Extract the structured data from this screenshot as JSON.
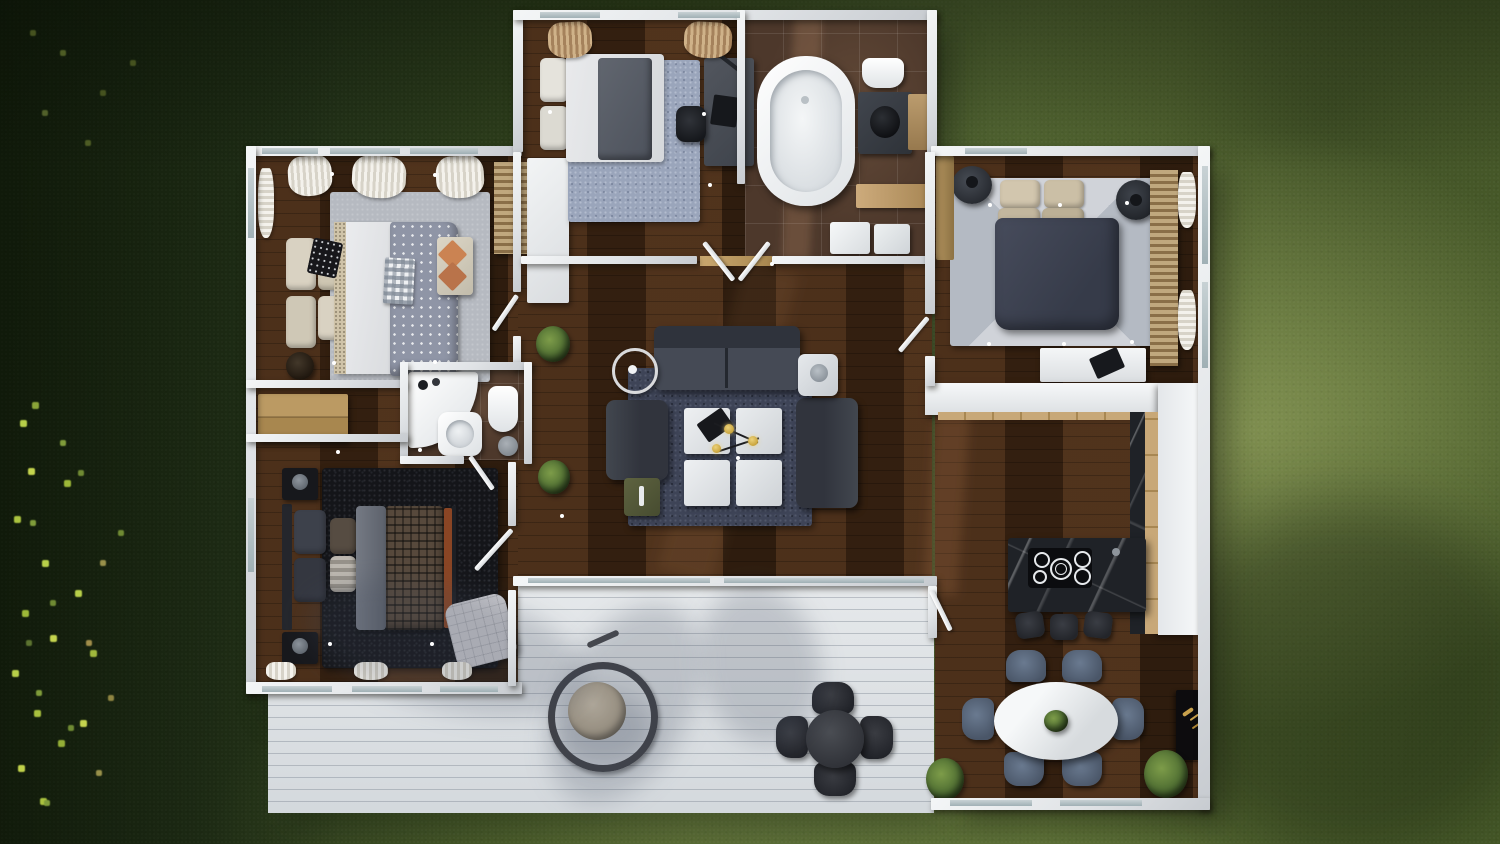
{
  "scene": {
    "type": "3d-architectural-render",
    "view": "top-down-aerial",
    "subject": "single-story furnished house floor plan with white walls, dark wood floors, white deck and surrounding lawn",
    "lighting": "daylight with tree shadows over deck and lawn, scattered leaves on grass at left"
  },
  "palette": {
    "grass-dark": "#1b2911",
    "grass-mid": "#4d6030",
    "grass-light": "#7b8b4e",
    "wood-floor": "#3a2413",
    "tile-brown": "#4d382b",
    "wall-white": "#e8eaec",
    "deck-white": "#dde1e4",
    "rug-light": "#b6bac1",
    "rug-blue": "#9aa5bb",
    "rug-navy": "#3e4457",
    "rug-black": "#141519",
    "rug-master": "#c5c9d0",
    "sofa-charcoal": "#3a3e48",
    "duvet-navy": "#3f4554",
    "pillow-cream": "#d6cfbf",
    "marble-black": "#1f2227",
    "counter-wood": "#c8a878",
    "dining-chair-blue": "#5d6c80",
    "plant-green": "#4c6b31",
    "leaf-bright": "#b7cf49",
    "accent-rust": "#8a4524",
    "accent-orange": "#cb8352",
    "gold-brass": "#c9a43c"
  },
  "rooms": [
    {
      "name": "bedroom-top-left",
      "furniture": [
        "double-bed-polka-dot-duvet",
        "cream-pillow-stacks",
        "light-gray-area-rug",
        "foot-bench-with-orange-trays",
        "checkered-throw",
        "round-side-table-with-lamp",
        "white-window-curtains"
      ]
    },
    {
      "name": "guest-bedroom-office",
      "furniture": [
        "bed-with-gray-throw",
        "blue-gray-rug",
        "desk-with-laptop-and-lamp",
        "black-office-chair",
        "white-wardrobe",
        "tan-curtains"
      ]
    },
    {
      "name": "main-bathroom",
      "furniture": [
        "freestanding-oval-bathtub",
        "dark-vanity-with-black-basin",
        "toilet",
        "wood-shelf",
        "washer-dryer-units",
        "wood-counter",
        "double-open-doors"
      ]
    },
    {
      "name": "master-bedroom",
      "furniture": [
        "king-bed-navy-duvet",
        "beige-pillows",
        "diamond-pattern-gray-rug",
        "round-dark-nightstands-with-lamps",
        "white-dresser-with-laptop",
        "wood-slat-bench",
        "window-curtains"
      ]
    },
    {
      "name": "living-room",
      "furniture": [
        "charcoal-sofa",
        "two-dark-armchairs",
        "navy-area-rug",
        "four-white-coffee-tables",
        "brass-pendant-lamp",
        "ring-floor-lamp",
        "round-side-table",
        "olive-ottoman-tray",
        "potted-plants"
      ]
    },
    {
      "name": "small-bathroom",
      "furniture": [
        "corner-shower-sink-unit",
        "toilet",
        "round-stool"
      ]
    },
    {
      "name": "bedroom-bottom-left",
      "furniture": [
        "double-bed-plaid-duvet",
        "black-shag-rug",
        "black-nightstands-with-lamps",
        "quilted-lounge-chair",
        "wood-console"
      ]
    },
    {
      "name": "kitchen-dining",
      "furniture": [
        "black-marble-island-with-cooktop",
        "three-bar-stools",
        "l-shaped-white-counter-with-wood-fronts",
        "white-oval-dining-table",
        "six-blue-upholstered-chairs",
        "plant-centerpiece",
        "black-wall-art-with-gold-bird",
        "potted-plants"
      ]
    },
    {
      "name": "deck",
      "furniture": [
        "hanging-egg-chair",
        "round-outdoor-dining-table",
        "four-dark-outdoor-chairs"
      ]
    }
  ],
  "exterior": {
    "lawn": "green grass darker at left and top, brightest beside the right wall",
    "leaves": "scattered bright tree leaves along the left edge",
    "shadows": "soft tree shadows cast across white deck and bottom-right lawn"
  }
}
